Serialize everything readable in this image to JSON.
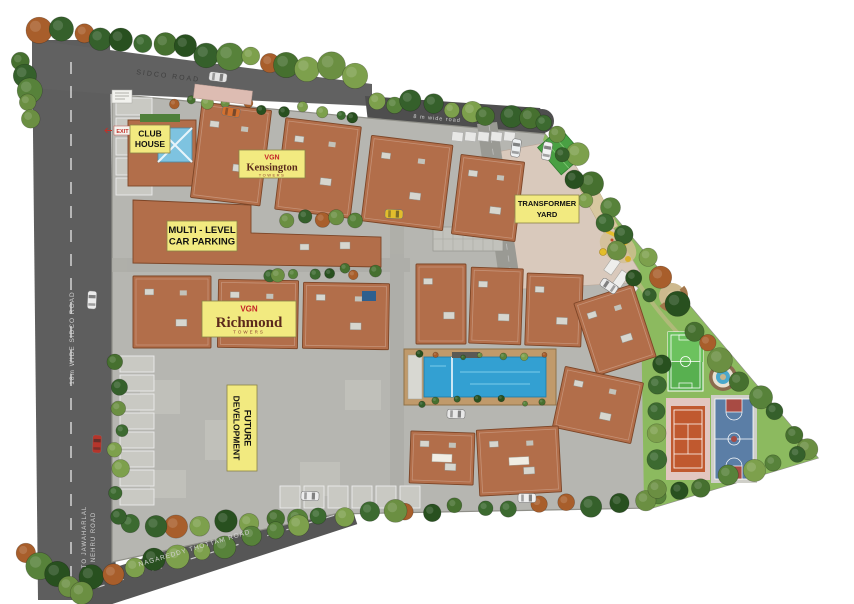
{
  "labels": {
    "club_house": {
      "line1": "CLUB",
      "line2": "HOUSE"
    },
    "kensington": {
      "brand": "VGN",
      "name": "Kensington",
      "suffix": "TOWERS"
    },
    "multi_level_parking": {
      "line1": "MULTI - LEVEL",
      "line2": "CAR PARKING"
    },
    "transformer_yard": {
      "line1": "TRANSFORMER",
      "line2": "YARD"
    },
    "richmond": {
      "brand": "VGN",
      "name": "Richmond",
      "suffix": "TOWERS"
    },
    "future_development": {
      "line1": "FUTURE",
      "line2": "DEVELOPMENT"
    },
    "exit": "EXIT"
  },
  "roads": {
    "sidco": "SIDCO  ROAD",
    "eight_m": "8 m wide road",
    "sidco_18m": "18m WIDE SIDCO ROAD",
    "jawaharlal_line1": "TO JAWAHARLAL",
    "jawaharlal_line2": "NEHRU ROAD",
    "nagareddy": "NAGAREDDY THOTTAM ROAD"
  },
  "colors": {
    "label_yellow": "#f2ea80",
    "brand_red": "#c42127",
    "road_gray": "#5b5b5b",
    "site_gray": "#b6b6b1",
    "lawn_green": "#8cba5f",
    "roof_terracotta": "#b26e4a",
    "pool_blue": "#33a0d2",
    "tennis_orange": "#c0592f",
    "basketball_blue": "#5b7ea6",
    "futsal_green": "#58b050"
  }
}
